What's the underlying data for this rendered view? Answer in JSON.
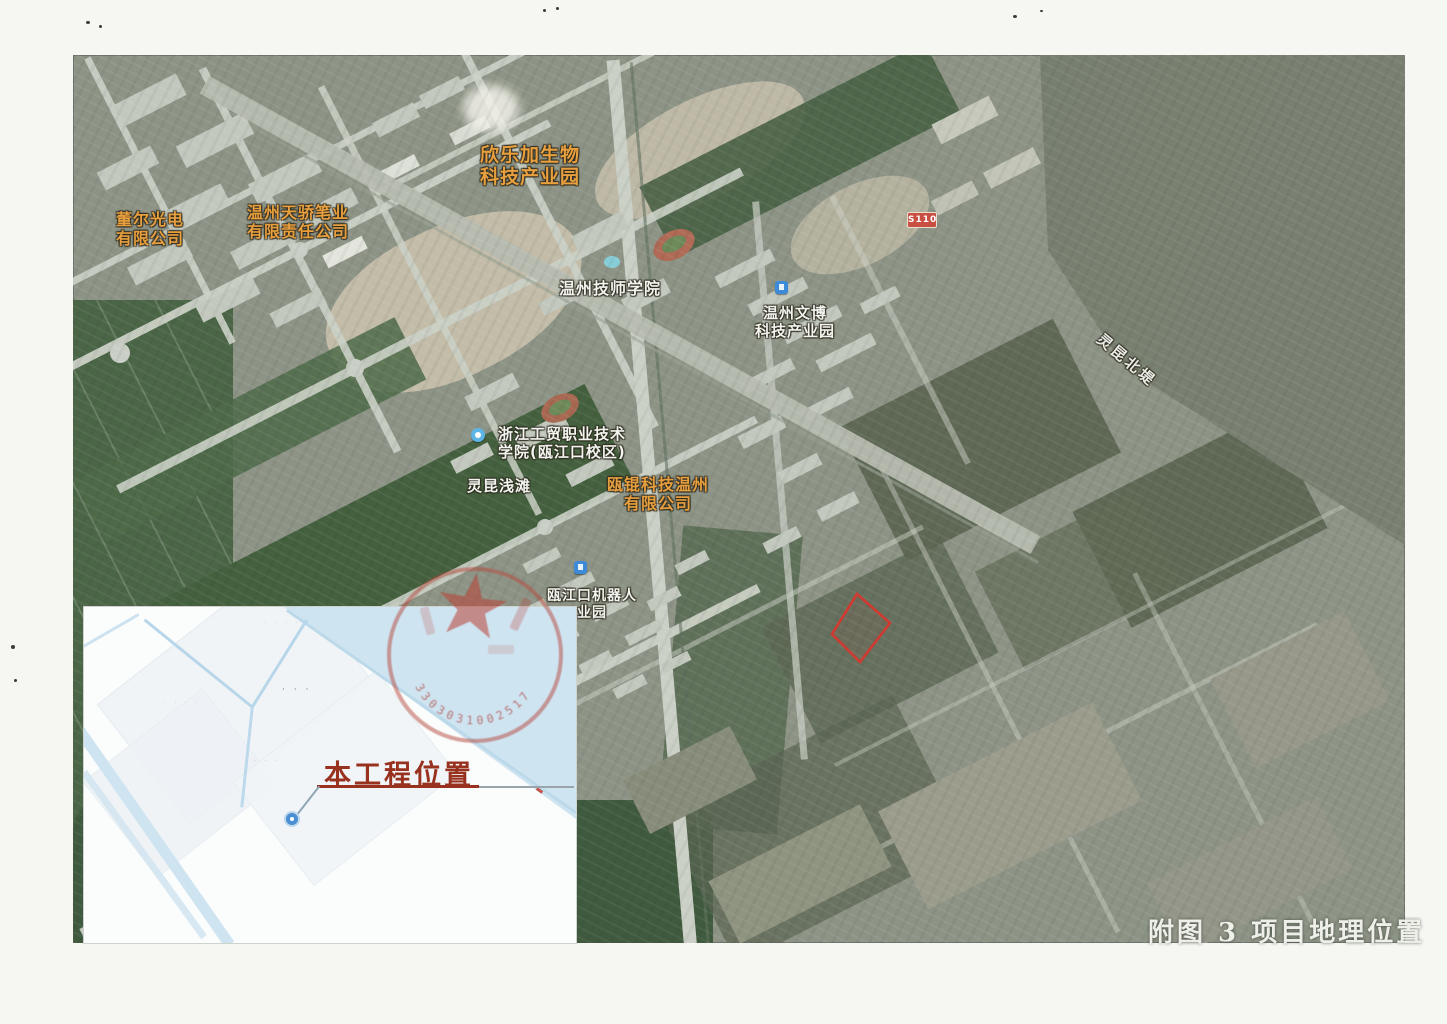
{
  "page": {
    "caption": "附图 3 项目地理位置"
  },
  "map_labels": {
    "xinlejia": {
      "line1": "欣乐加生物",
      "line2": "科技产业园"
    },
    "dongr": {
      "line1": "董尔光电",
      "line2": "有限公司"
    },
    "tianjiao": {
      "line1": "温州天骄笔业",
      "line2": "有限责任公司"
    },
    "jishi": {
      "text": "温州技师学院"
    },
    "wenbo": {
      "line1": "温州文博",
      "line2": "科技产业园"
    },
    "gongmao": {
      "line1": "浙江工贸职业技术",
      "line2": "学院(瓯江口校区)"
    },
    "qiantan": {
      "text": "灵昆浅滩"
    },
    "oukun": {
      "line1": "瓯锟科技温州",
      "line2": "有限公司"
    },
    "robot": {
      "line1": "瓯江口机器人",
      "line2": "业园"
    },
    "road_shield": {
      "text": "S110"
    },
    "dike": {
      "text": "灵昆北堤"
    }
  },
  "inset": {
    "label": "本工程位置"
  },
  "stamp": {
    "numbers": "3303031002517"
  },
  "colors": {
    "label_orange": "#e89f3e",
    "label_white": "#f2f4ef",
    "boundary_red": "#d13a30",
    "seal_red": "#b5473c",
    "inset_water": "#cfe4f1",
    "inset_label_red": "#98321f",
    "road_shield_red": "#c94f43"
  }
}
